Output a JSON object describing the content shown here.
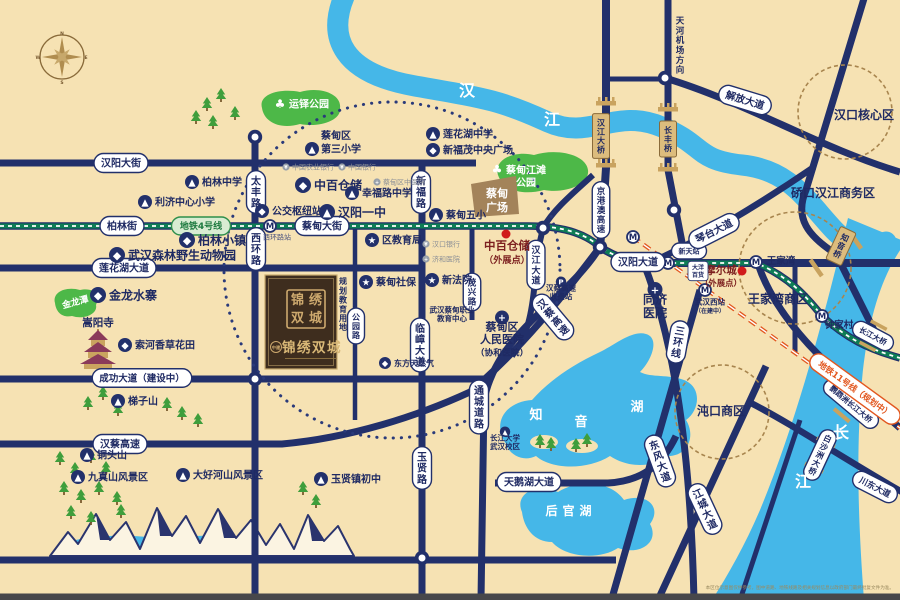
{
  "colors": {
    "sand": "#f6e2b3",
    "road": "#22306b",
    "water": "#45b7e8",
    "park": "#4db848",
    "navy_text": "#1f2a63",
    "metro_green": "#0e7d55",
    "metro_orange": "#e2571f",
    "gold": "#dcbc7d",
    "brown": "#a3835a",
    "red": "#d01b1b",
    "dark_red": "#7c1f1f",
    "gray": "#8b8f96",
    "project_bg": "#3e2d1e",
    "project_gold": "#cda96e"
  },
  "icons": {
    "school": "▲",
    "shop": "◆",
    "star": "★",
    "hosp": "+",
    "mtn": "▲",
    "bus": "◆",
    "bank": "¥",
    "cross": "+",
    "toll": "P",
    "metro": "M",
    "tree": "♣"
  },
  "compass": {
    "letters": [
      "N",
      "E",
      "S",
      "W"
    ]
  },
  "project": {
    "brand": "中建",
    "name": "锦绣双城",
    "seal_chars": [
      "锦",
      "绣",
      "双",
      "城"
    ],
    "land_note": "规划教育用地"
  },
  "footer": {
    "disclaimer": "本区位示意图仅供参考，图中道路、地铁线路及相关规划信息以政府部门最终批复文件为准。"
  },
  "labels": [
    {
      "k": "pill",
      "t": "汉阳大街",
      "x": 121,
      "y": 163
    },
    {
      "k": "pill",
      "t": "柏林街",
      "x": 122,
      "y": 226
    },
    {
      "k": "gpill",
      "t": "地铁4号线",
      "x": 201,
      "y": 226,
      "s": 9
    },
    {
      "k": "pill",
      "t": "蔡甸大街",
      "x": 322,
      "y": 226
    },
    {
      "k": "pill",
      "t": "莲花湖大道",
      "x": 124,
      "y": 268
    },
    {
      "k": "pill",
      "t": "成功大道（建设中）",
      "x": 142,
      "y": 378,
      "s": 9.5
    },
    {
      "k": "pill",
      "t": "汉蔡高速",
      "x": 120,
      "y": 444
    },
    {
      "k": "pill",
      "t": "天鹅湖大道",
      "x": 529,
      "y": 482
    },
    {
      "k": "pill",
      "t": "汉阳大道",
      "x": 638,
      "y": 262
    },
    {
      "k": "pill",
      "t": "新天站",
      "x": 689,
      "y": 251,
      "s": 7
    },
    {
      "k": "pill",
      "t": "解放大道",
      "x": 745,
      "y": 100,
      "r": 17
    },
    {
      "k": "pill",
      "t": "琴台大道",
      "x": 714,
      "y": 231,
      "r": -27
    },
    {
      "k": "pillr",
      "t": "川东大道",
      "x": 875,
      "y": 487,
      "r": 27,
      "s": 8.5
    },
    {
      "k": "pillr",
      "t": "鹦鹉洲长江大桥",
      "x": 851,
      "y": 404,
      "r": 40,
      "s": 7.5
    },
    {
      "k": "pillr",
      "t": "长江大桥",
      "x": 873,
      "y": 336,
      "r": 28,
      "s": 7.5
    },
    {
      "k": "opill",
      "t": "地铁11号线（规划中）",
      "x": 855,
      "y": 389,
      "r": 36,
      "s": 8.5
    },
    {
      "k": "pillv",
      "t": "东风大道",
      "x": 660,
      "y": 461,
      "r": -20
    },
    {
      "k": "pillv",
      "t": "江城大道",
      "x": 705,
      "y": 509,
      "r": -25
    },
    {
      "k": "pillv",
      "t": "三环线",
      "x": 678,
      "y": 342,
      "r": 10
    },
    {
      "k": "pillv",
      "t": "汉蔡高速",
      "x": 553,
      "y": 317,
      "r": -40
    },
    {
      "k": "pillv",
      "t": "京港澳高速",
      "x": 601,
      "y": 210,
      "s": 8.5
    },
    {
      "k": "pillv",
      "t": "太丰路",
      "x": 256,
      "y": 192
    },
    {
      "k": "pillv",
      "t": "西环路",
      "x": 256,
      "y": 249
    },
    {
      "k": "pillv",
      "t": "新福路",
      "x": 421,
      "y": 192
    },
    {
      "k": "pillv",
      "t": "临嶂大道",
      "x": 420,
      "y": 345
    },
    {
      "k": "pillv",
      "t": "玉贤路",
      "x": 422,
      "y": 468
    },
    {
      "k": "pillv",
      "t": "公园路",
      "x": 356,
      "y": 326,
      "s": 8
    },
    {
      "k": "pillv",
      "t": "茂兴路",
      "x": 472,
      "y": 292,
      "s": 8.5
    },
    {
      "k": "pillv",
      "t": "汉江大道",
      "x": 536,
      "y": 265,
      "s": 9
    },
    {
      "k": "pillv",
      "t": "通城道路",
      "x": 479,
      "y": 407
    },
    {
      "k": "pillv",
      "t": "白沙洲大桥",
      "x": 820,
      "y": 455,
      "r": 25,
      "s": 8
    },
    {
      "k": "goldv",
      "t": "汉江大桥",
      "x": 601,
      "y": 136
    },
    {
      "k": "goldv",
      "t": "长丰桥",
      "x": 668,
      "y": 139
    },
    {
      "k": "goldv",
      "t": "知音桥",
      "x": 841,
      "y": 246,
      "r": 25
    },
    {
      "k": "area",
      "t": "汉口核心区",
      "x": 864,
      "y": 119,
      "s": 12
    },
    {
      "k": "area",
      "t": "硚口汉江商务区",
      "x": 833,
      "y": 197,
      "s": 12
    },
    {
      "k": "area",
      "t": "王家湾商区",
      "x": 778,
      "y": 303,
      "s": 12
    },
    {
      "k": "area",
      "t": "沌口商区",
      "x": 721,
      "y": 415,
      "s": 12
    },
    {
      "k": "area",
      "t": "王家湾",
      "x": 781,
      "y": 264,
      "s": 9.5
    },
    {
      "k": "area",
      "t": "钟家村",
      "x": 839,
      "y": 328,
      "s": 9.5
    },
    {
      "k": "area",
      "t": "嵩阳寺",
      "x": 98,
      "y": 326,
      "s": 10.5
    },
    {
      "k": "areav",
      "t": "天河机场方向",
      "x": 680,
      "y": 16,
      "s": 8.5
    },
    {
      "k": "areav",
      "t": "规划教育用地",
      "x": 343,
      "y": 277,
      "s": 8
    },
    {
      "k": "water",
      "t": "汉",
      "x": 467,
      "y": 96,
      "s": 16
    },
    {
      "k": "water",
      "t": "江",
      "x": 552,
      "y": 125,
      "s": 16
    },
    {
      "k": "water",
      "t": "长",
      "x": 841,
      "y": 438,
      "s": 16
    },
    {
      "k": "water",
      "t": "江",
      "x": 803,
      "y": 487,
      "s": 16
    },
    {
      "k": "water",
      "t": "知",
      "x": 536,
      "y": 419,
      "s": 13
    },
    {
      "k": "water",
      "t": "音",
      "x": 581,
      "y": 426,
      "s": 13
    },
    {
      "k": "water",
      "t": "湖",
      "x": 637,
      "y": 411,
      "s": 13
    },
    {
      "k": "water",
      "t": "后官湖",
      "x": 571,
      "y": 515,
      "s": 12,
      "ls": 5
    },
    {
      "k": "water",
      "t": "金龙潭",
      "x": 76,
      "y": 305,
      "s": 9,
      "r": -15
    },
    {
      "k": "park",
      "t": "运铎公园",
      "x": 309,
      "y": 104,
      "s": 10
    },
    {
      "k": "park2",
      "lines": [
        "蔡甸江滩",
        "公园"
      ],
      "x": 526,
      "y": 176,
      "s": 10,
      "ic": "tree"
    },
    {
      "k": "park2",
      "lines": [
        "蔡甸",
        "广场"
      ],
      "x": 497,
      "y": 200,
      "s": 11
    },
    {
      "k": "poi",
      "t": "柏林中学",
      "x": 192,
      "y": 182,
      "ic": "school"
    },
    {
      "k": "poi",
      "t": "利济中心小学",
      "x": 145,
      "y": 202,
      "ic": "school"
    },
    {
      "k": "poiL",
      "lines": [
        "蔡甸区",
        "第三小学"
      ],
      "x": 312,
      "y": 139,
      "ic": "school"
    },
    {
      "k": "poi",
      "t": "莲花湖中学",
      "x": 433,
      "y": 134,
      "ic": "school"
    },
    {
      "k": "poi",
      "t": "新福茂中央广场",
      "x": 433,
      "y": 150,
      "ic": "shop"
    },
    {
      "k": "poi",
      "t": "中百仓储",
      "x": 303,
      "y": 185,
      "ic": "shop",
      "s": 12
    },
    {
      "k": "poi",
      "t": "幸福路中学",
      "x": 352,
      "y": 193,
      "ic": "school"
    },
    {
      "k": "poi",
      "t": "公交枢纽站",
      "x": 262,
      "y": 211,
      "ic": "bus"
    },
    {
      "k": "poi",
      "t": "汉阳一中",
      "x": 327,
      "y": 212,
      "ic": "school",
      "s": 12
    },
    {
      "k": "poi",
      "t": "蔡甸五小",
      "x": 436,
      "y": 215,
      "ic": "school"
    },
    {
      "k": "poi",
      "t": "区教育局",
      "x": 372,
      "y": 240,
      "ic": "star"
    },
    {
      "k": "poi",
      "t": "蔡甸社保",
      "x": 366,
      "y": 282,
      "ic": "star"
    },
    {
      "k": "poi",
      "t": "新法院",
      "x": 432,
      "y": 280,
      "ic": "star"
    },
    {
      "k": "poi",
      "t": "柏林小镇",
      "x": 187,
      "y": 240,
      "ic": "shop",
      "s": 12
    },
    {
      "k": "poi",
      "t": "武汉森林野生动物园",
      "x": 117,
      "y": 255,
      "ic": "shop",
      "s": 12
    },
    {
      "k": "poi",
      "t": "金龙水寨",
      "x": 98,
      "y": 295,
      "ic": "shop",
      "s": 12
    },
    {
      "k": "poi",
      "t": "索河香草花田",
      "x": 125,
      "y": 345,
      "ic": "shop"
    },
    {
      "k": "poi",
      "t": "梯子山",
      "x": 118,
      "y": 401,
      "ic": "mtn"
    },
    {
      "k": "poi",
      "t": "铜头山",
      "x": 87,
      "y": 455,
      "ic": "mtn"
    },
    {
      "k": "poi",
      "t": "九真山风景区",
      "x": 78,
      "y": 477,
      "ic": "mtn"
    },
    {
      "k": "poi",
      "t": "大好河山风景区",
      "x": 183,
      "y": 475,
      "ic": "mtn"
    },
    {
      "k": "poi",
      "t": "玉贤镇初中",
      "x": 321,
      "y": 479,
      "ic": "school"
    },
    {
      "k": "poi",
      "t": "东方天然气",
      "x": 385,
      "y": 363,
      "ic": "shop",
      "s": 8
    },
    {
      "k": "poi2",
      "lines": [
        "武汉蔡甸职业",
        "教育中心"
      ],
      "x": 452,
      "y": 314,
      "s": 7.5
    },
    {
      "k": "poi2",
      "lines": [
        "蔡甸区",
        "人民医院",
        "（协和医院）"
      ],
      "x": 502,
      "y": 339,
      "s": 11,
      "ic": "hosp"
    },
    {
      "k": "poi2",
      "lines": [
        "同济",
        "医院"
      ],
      "x": 655,
      "y": 306,
      "s": 12,
      "ic": "hosp"
    },
    {
      "k": "poi2",
      "lines": [
        "长江大学",
        "武汉校区"
      ],
      "x": 505,
      "y": 442,
      "s": 7.5,
      "ic": "school"
    },
    {
      "k": "poi2",
      "lines": [
        "武汉西站",
        "（在建中）"
      ],
      "x": 710,
      "y": 306,
      "s": 7.5
    },
    {
      "k": "poi2",
      "lines": [
        "汉蔡高速",
        "收费站"
      ],
      "x": 561,
      "y": 292,
      "s": 7.5,
      "ic": "toll"
    },
    {
      "k": "red2",
      "lines": [
        "中百仓储",
        "（外展点）"
      ],
      "x": 507,
      "y": 252,
      "s": 11.5
    },
    {
      "k": "red2",
      "lines": [
        "摩尔城",
        "（外展点）"
      ],
      "x": 721,
      "y": 276,
      "s": 10.5
    },
    {
      "k": "tiny",
      "t": "中国农业银行",
      "x": 286,
      "y": 167,
      "ic": "bank"
    },
    {
      "k": "tiny",
      "t": "中国银行",
      "x": 342,
      "y": 167,
      "ic": "bank"
    },
    {
      "k": "tiny",
      "t": "蔡甸区中医院",
      "x": 377,
      "y": 182,
      "ic": "cross"
    },
    {
      "k": "tiny",
      "t": "汉口银行",
      "x": 426,
      "y": 244,
      "ic": "bank"
    },
    {
      "k": "tiny",
      "t": "济和医院",
      "x": 426,
      "y": 259,
      "ic": "cross"
    },
    {
      "k": "tiny",
      "t": "西环路站",
      "x": 277,
      "y": 237,
      "c": "#4a5380"
    },
    {
      "k": "tpill",
      "lines": [
        "大洋",
        "百货"
      ],
      "x": 698,
      "y": 271,
      "s": 6
    }
  ],
  "m_stations": [
    [
      270,
      226
    ],
    [
      668,
      263
    ],
    [
      756,
      262
    ],
    [
      822,
      316
    ],
    [
      633,
      237
    ],
    [
      705,
      290
    ]
  ],
  "junctions": [
    [
      255,
      137
    ],
    [
      543,
      228
    ],
    [
      600,
      247
    ],
    [
      665,
      78
    ],
    [
      674,
      210
    ],
    [
      255,
      379
    ],
    [
      422,
      558
    ]
  ],
  "red_dots": [
    [
      506,
      234
    ],
    [
      742,
      271
    ]
  ],
  "trees": [
    [
      207,
      107
    ],
    [
      221,
      98
    ],
    [
      235,
      116
    ],
    [
      213,
      125
    ],
    [
      196,
      120
    ],
    [
      88,
      406
    ],
    [
      103,
      396
    ],
    [
      118,
      412
    ],
    [
      167,
      407
    ],
    [
      182,
      416
    ],
    [
      198,
      423
    ],
    [
      60,
      461
    ],
    [
      75,
      472
    ],
    [
      91,
      459
    ],
    [
      106,
      471
    ],
    [
      64,
      491
    ],
    [
      81,
      499
    ],
    [
      99,
      491
    ],
    [
      117,
      501
    ],
    [
      71,
      515
    ],
    [
      91,
      521
    ],
    [
      121,
      514
    ],
    [
      303,
      491
    ],
    [
      316,
      504
    ],
    [
      540,
      444
    ],
    [
      551,
      447
    ],
    [
      576,
      448
    ],
    [
      587,
      443
    ]
  ]
}
